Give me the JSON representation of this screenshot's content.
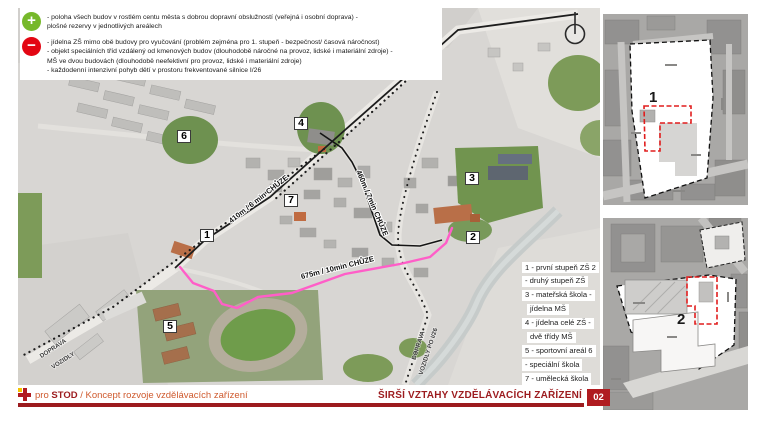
{
  "colors": {
    "positive_green": "#76b82a",
    "negative_red": "#e30613",
    "accent_dark_red": "#9c1b1e",
    "page_number_red": "#b01b20",
    "route_pink": "#ff5ec8"
  },
  "icons": {
    "positive": "plus-icon",
    "negative": "minus-icon",
    "north": "north-arrow-icon"
  },
  "legend": {
    "pros": {
      "lines": [
        "- poloha všech budov v rostlém centu města s dobrou dopravní obslužností (veřejná i osobní doprava) -",
        "plošné rezervy v jednotlivých areálech"
      ]
    },
    "cons": {
      "lines": [
        "- jídelna ZŠ mimo obě budovy pro vyučování (problém zejména pro 1. stupeň - bezpečnost/ časová náročnost)",
        "- objekt speciálních tříd vzdálený od kmenových budov (dlouhodobě náročné na provoz, lidské i materiální zdroje) -",
        "MŠ ve dvou budovách (dlouhodobě neefektivní pro provoz, lidské i materiální zdroje)",
        "- každodenní intenzivní pohyb dětí v prostoru frekventované silnice I/26"
      ]
    }
  },
  "map": {
    "markers": [
      {
        "n": "1"
      },
      {
        "n": "2"
      },
      {
        "n": "3"
      },
      {
        "n": "4"
      },
      {
        "n": "5"
      },
      {
        "n": "6"
      },
      {
        "n": "7"
      }
    ],
    "route_labels": {
      "r410": "410m / 6 min CHŮZE",
      "r460": "460m / 7min CHŮZE",
      "r675": "675m / 10min CHŮZE"
    },
    "road_labels": {
      "a1": "DOPRAVA",
      "a2": "VOZIDLY",
      "b1": "DOPRAVA",
      "b2": "VOZIDLY PO I/26"
    },
    "list": [
      "1 - první stupeň ZŠ 2",
      "- druhý stupeň ZŠ",
      "3 - mateřská škola -",
      "jídelna MŠ",
      "4 - jídelna celé ZŠ -",
      "dvě třídy MŠ",
      "5 - sportovní areál 6",
      "- speciální škola",
      "7 - umělecká škola"
    ]
  },
  "panels": [
    {
      "label": "1"
    },
    {
      "label": "2"
    }
  ],
  "footer": {
    "brand_pre": "pro",
    "brand_name": "STOD",
    "brand_rest": "/ Koncept rozvoje vzdělávacích zařízení",
    "title": "ŠIRŠÍ VZTAHY VZDĚLÁVACÍCH ZAŘÍZENÍ",
    "page_num": "02"
  }
}
